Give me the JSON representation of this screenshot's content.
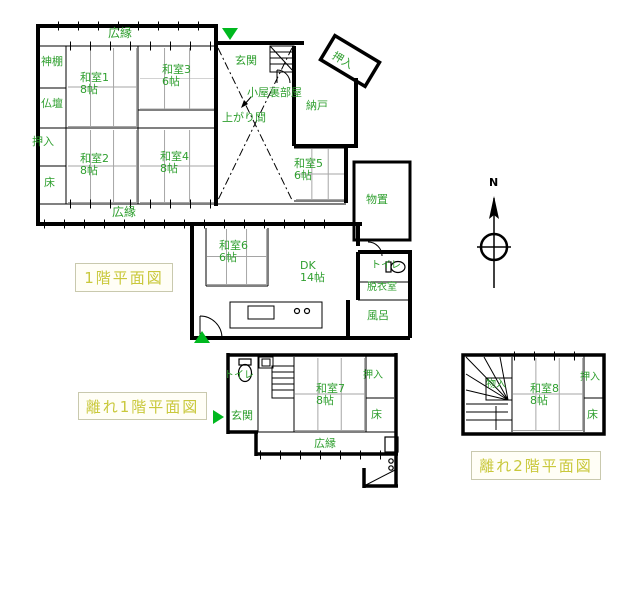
{
  "colors": {
    "wall": "#000000",
    "room_label_green": "#2f9f2f",
    "plan_title_yellow": "#c9c83b",
    "entrance_marker_green": "#00b81f"
  },
  "titles": {
    "floor1": "1階平面図",
    "annex1": "離れ1階平面図",
    "annex2": "離れ2階平面図"
  },
  "compass": {
    "north": "N"
  },
  "main_house": {
    "veranda_top": {
      "label": "広縁"
    },
    "kamidana": {
      "label": "神棚"
    },
    "butsudan": {
      "label": "仏壇"
    },
    "oshiire_left": {
      "label": "押入"
    },
    "tokonoma_left": {
      "label": "床"
    },
    "washitsu1": {
      "label": "和室1",
      "size": "8帖"
    },
    "washitsu2": {
      "label": "和室2",
      "size": "8帖"
    },
    "washitsu3": {
      "label": "和室3",
      "size": "6帖"
    },
    "washitsu4": {
      "label": "和室4",
      "size": "8帖"
    },
    "washitsu5": {
      "label": "和室5",
      "size": "6帖"
    },
    "washitsu6": {
      "label": "和室6",
      "size": "6帖"
    },
    "veranda_bottom": {
      "label": "広縁"
    },
    "genkan": {
      "label": "玄関"
    },
    "koyaura": {
      "label": "小屋裏部屋"
    },
    "agarima": {
      "label": "上がり間"
    },
    "nando": {
      "label": "納戸"
    },
    "oshiire_diag": {
      "label": "押入"
    },
    "monooki": {
      "label": "物置"
    },
    "dk": {
      "label": "DK",
      "size": "14帖"
    },
    "toilet": {
      "label": "トイレ"
    },
    "datsuishitsu": {
      "label": "脱衣室"
    },
    "furo": {
      "label": "風呂"
    }
  },
  "annex_1f": {
    "toilet": {
      "label": "トイレ"
    },
    "genkan": {
      "label": "玄関"
    },
    "washitsu7": {
      "label": "和室7",
      "size": "8帖"
    },
    "oshiire": {
      "label": "押入"
    },
    "tokonoma": {
      "label": "床"
    },
    "veranda": {
      "label": "広縁"
    }
  },
  "annex_2f": {
    "monoire": {
      "label": "物入"
    },
    "washitsu8": {
      "label": "和室8",
      "size": "8帖"
    },
    "oshiire": {
      "label": "押入"
    },
    "tokonoma": {
      "label": "床"
    }
  }
}
